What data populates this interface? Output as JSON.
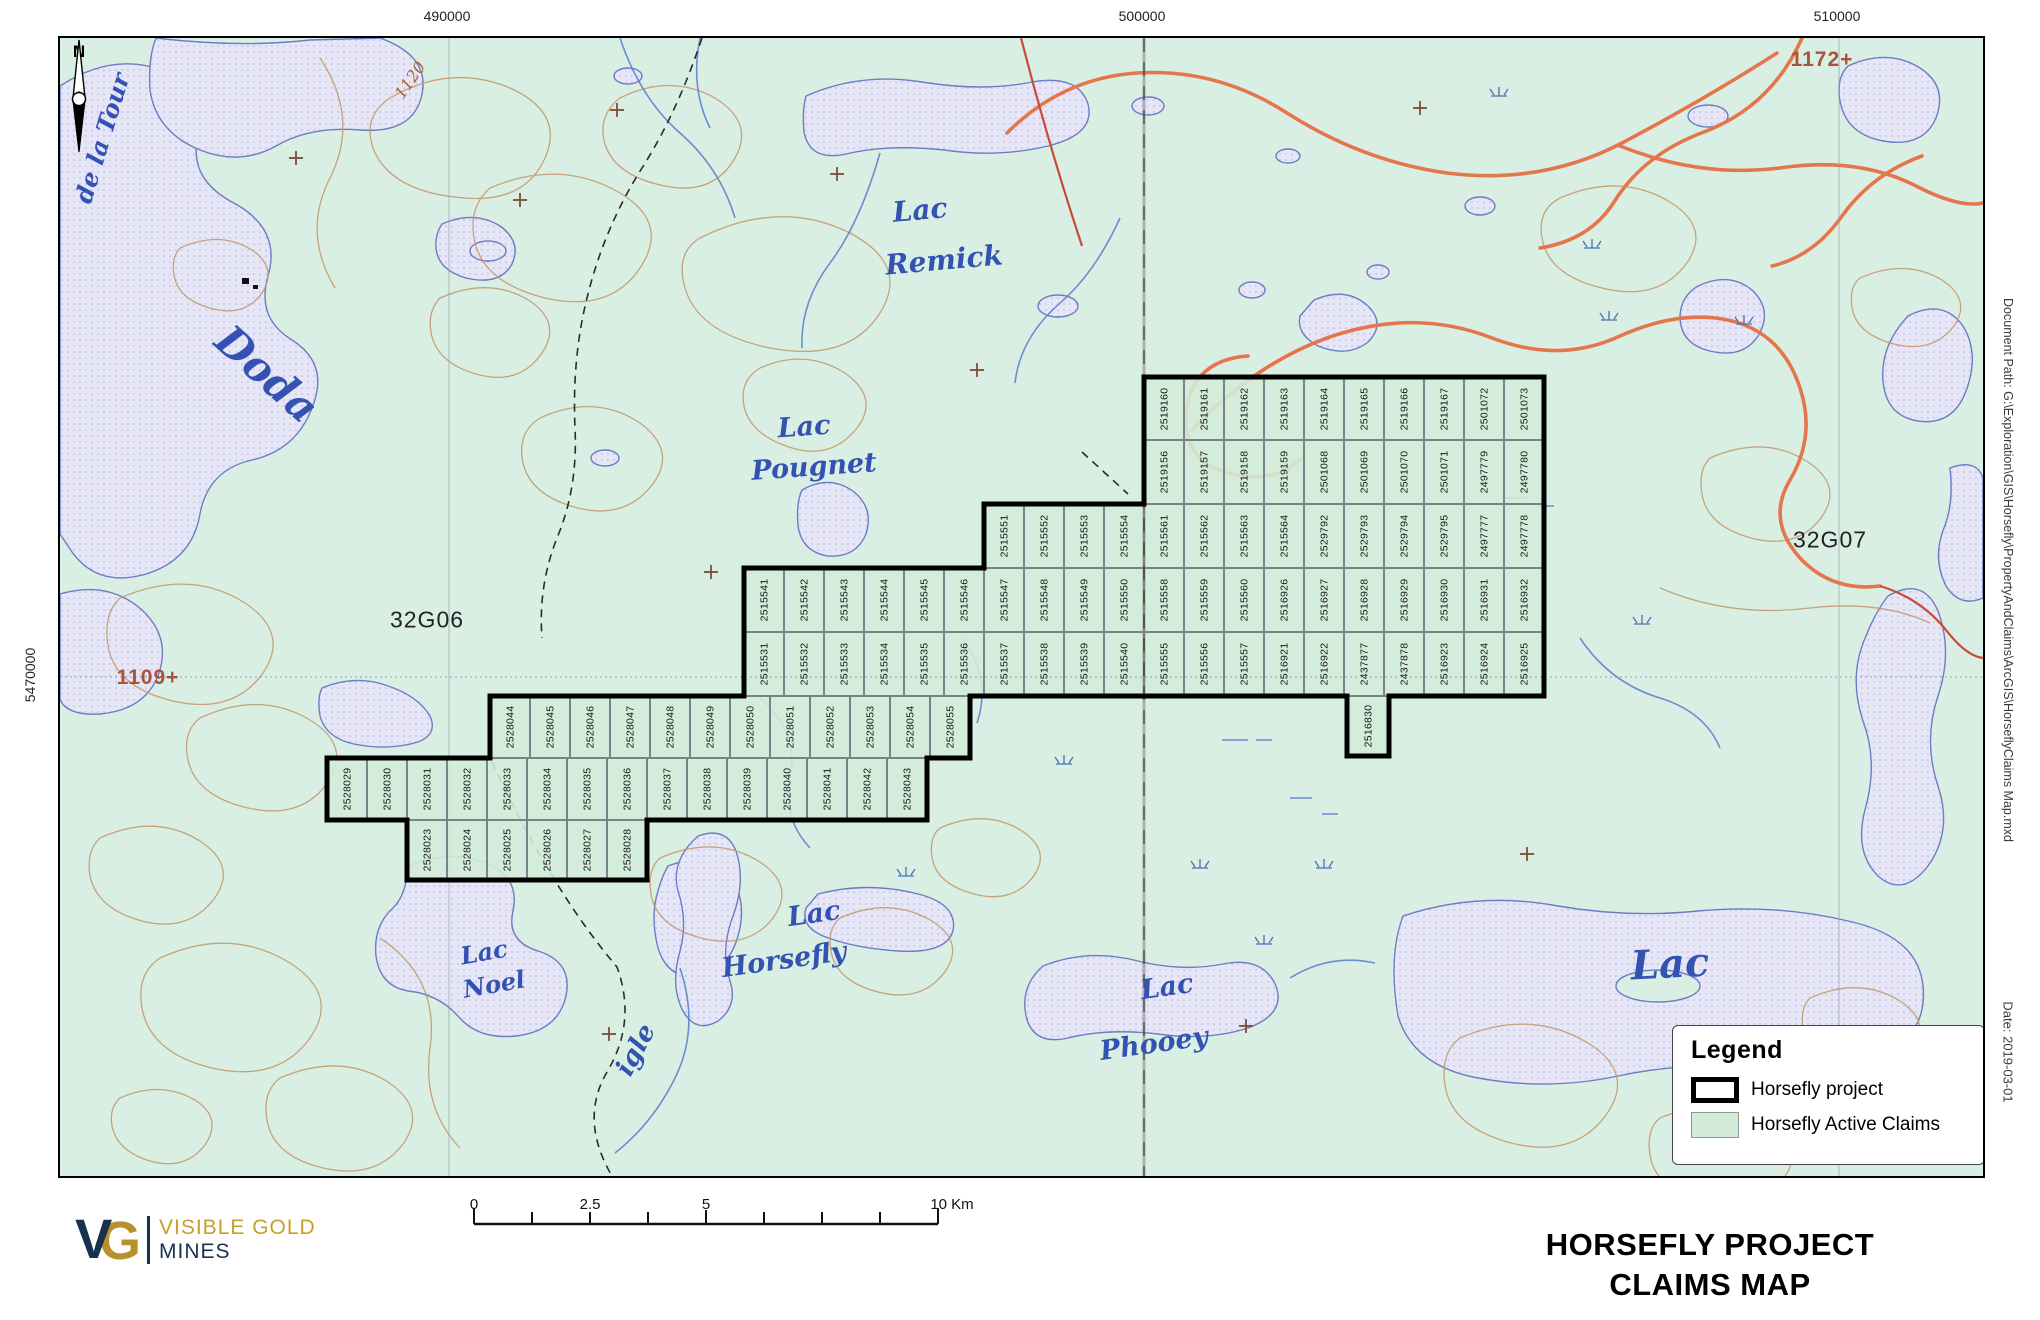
{
  "header_coords": {
    "top": [
      "490000",
      "500000",
      "510000"
    ],
    "left": "5470000"
  },
  "north_label": "N",
  "map_labels": [
    {
      "text": "de la Tour",
      "x": 42,
      "y": 100,
      "rot": -73,
      "cls": "",
      "size": 24
    },
    {
      "text": "Doda",
      "x": 207,
      "y": 336,
      "rot": 42,
      "cls": "",
      "size": 42
    },
    {
      "text": "1120",
      "x": 350,
      "y": 42,
      "rot": -55,
      "cls": "contour-label",
      "size": 16
    },
    {
      "text": "Lac",
      "x": 860,
      "y": 172,
      "rot": -5,
      "cls": "",
      "size": 28
    },
    {
      "text": "Remick",
      "x": 884,
      "y": 222,
      "rot": -5,
      "cls": "",
      "size": 28
    },
    {
      "text": "Lac",
      "x": 744,
      "y": 389,
      "rot": -4,
      "cls": "",
      "size": 27
    },
    {
      "text": "Pougnet",
      "x": 754,
      "y": 429,
      "rot": -4,
      "cls": "",
      "size": 27
    },
    {
      "text": "32G06",
      "x": 367,
      "y": 582,
      "rot": 0,
      "cls": "sheet",
      "size": 23
    },
    {
      "text": "32G07",
      "x": 1770,
      "y": 502,
      "rot": 0,
      "cls": "sheet",
      "size": 23
    },
    {
      "text": "1109+",
      "x": 88,
      "y": 640,
      "rot": 0,
      "cls": "elev",
      "size": 21
    },
    {
      "text": "1172+",
      "x": 1762,
      "y": 22,
      "rot": 0,
      "cls": "elev",
      "size": 21
    },
    {
      "text": "Lac",
      "x": 424,
      "y": 914,
      "rot": -10,
      "cls": "",
      "size": 24
    },
    {
      "text": "Noel",
      "x": 434,
      "y": 946,
      "rot": -10,
      "cls": "",
      "size": 24
    },
    {
      "text": "Lac",
      "x": 754,
      "y": 876,
      "rot": -8,
      "cls": "",
      "size": 27
    },
    {
      "text": "Horsefly",
      "x": 724,
      "y": 922,
      "rot": -8,
      "cls": "",
      "size": 27
    },
    {
      "text": "Lac",
      "x": 1107,
      "y": 949,
      "rot": -8,
      "cls": "",
      "size": 27
    },
    {
      "text": "Phooey",
      "x": 1094,
      "y": 1006,
      "rot": -8,
      "cls": "",
      "size": 27
    },
    {
      "text": "Lac",
      "x": 1610,
      "y": 926,
      "rot": -3,
      "cls": "",
      "size": 40
    },
    {
      "text": "igle",
      "x": 576,
      "y": 1012,
      "rot": -62,
      "cls": "",
      "size": 26
    }
  ],
  "claims": {
    "rows": [
      {
        "x": 1084,
        "y": 339,
        "w": 40,
        "h": 63,
        "numbers": [
          "2519160",
          "2519161",
          "2519162",
          "2519163",
          "2519164",
          "2519165",
          "2519166",
          "2519167",
          "2501072",
          "2501073"
        ]
      },
      {
        "x": 1084,
        "y": 402,
        "w": 40,
        "h": 64,
        "numbers": [
          "2519156",
          "2519157",
          "2519158",
          "2519159",
          "2501068",
          "2501069",
          "2501070",
          "2501071",
          "2497779",
          "2497780"
        ]
      },
      {
        "x": 924,
        "y": 466,
        "w": 40,
        "h": 64,
        "numbers": [
          "2515551",
          "2515552",
          "2515553",
          "2515554",
          "2515561",
          "2515562",
          "2515563",
          "2515564",
          "2529792",
          "2529793",
          "2529794",
          "2529795",
          "2497777",
          "2497778"
        ]
      },
      {
        "x": 684,
        "y": 530,
        "w": 40,
        "h": 64,
        "numbers": [
          "2515541",
          "2515542",
          "2515543",
          "2515544",
          "2515545",
          "2515546",
          "2515547",
          "2515548",
          "2515549",
          "2515550",
          "2515558",
          "2515559",
          "2515560",
          "2516926",
          "2516927",
          "2516928",
          "2516929",
          "2516930",
          "2516931",
          "2516932"
        ]
      },
      {
        "x": 684,
        "y": 594,
        "w": 40,
        "h": 64,
        "numbers": [
          "2515531",
          "2515532",
          "2515533",
          "2515534",
          "2515535",
          "2515536",
          "2515537",
          "2515538",
          "2515539",
          "2515540",
          "2515555",
          "2515556",
          "2515557",
          "2516921",
          "2516922",
          "2437877",
          "2437878",
          "2516923",
          "2516924",
          "2516925"
        ]
      },
      {
        "x": 430,
        "y": 658,
        "w": 40,
        "h": 62,
        "numbers": [
          "2528044",
          "2528045",
          "2528046",
          "2528047",
          "2528048",
          "2528049",
          "2528050",
          "2528051",
          "2528052",
          "2528053",
          "2528054",
          "2528055"
        ]
      },
      {
        "x": 267,
        "y": 720,
        "w": 40,
        "h": 62,
        "numbers": [
          "2528029",
          "2528030",
          "2528031",
          "2528032",
          "2528033",
          "2528034",
          "2528035",
          "2528036",
          "2528037",
          "2528038",
          "2528039",
          "2528040",
          "2528041",
          "2528042",
          "2528043"
        ]
      },
      {
        "x": 347,
        "y": 782,
        "w": 40,
        "h": 60,
        "numbers": [
          "2528023",
          "2528024",
          "2528025",
          "2528026",
          "2528027",
          "2528028"
        ]
      }
    ],
    "hanging": {
      "x": 1287,
      "y": 658,
      "w": 42,
      "h": 60,
      "number": "2516830"
    }
  },
  "legend": {
    "title": "Legend",
    "items": [
      {
        "label": "Horsefly project"
      },
      {
        "label": "Horsefly Active Claims"
      }
    ]
  },
  "scalebar": {
    "labels": [
      "0",
      "2.5",
      "5",
      "10 Km"
    ]
  },
  "footer": {
    "title_line1": "HORSEFLY PROJECT",
    "title_line2": "CLAIMS MAP"
  },
  "logo": {
    "mark_v": "V",
    "mark_g": "G",
    "line1": "VISIBLE GOLD",
    "line2": "MINES"
  },
  "margin_notes": {
    "document_path": "Document Path: G:\\Exploration\\GIS\\Horsefly\\PropertyAndClaims\\ArcGIS\\HorseflyClaims Map.mxd",
    "date": "Date: 2019-03-01"
  },
  "colors": {
    "background_green": "#daefe4",
    "water_fill": "#e6e6f7",
    "water_stroke": "#6d7cc4",
    "contour_brown": "#c49a6e",
    "road_orange": "#e5764b",
    "claim_fill": "#d3edda",
    "project_outline": "#000000",
    "logo_gold": "#c4a02a",
    "logo_navy": "#16324f"
  }
}
